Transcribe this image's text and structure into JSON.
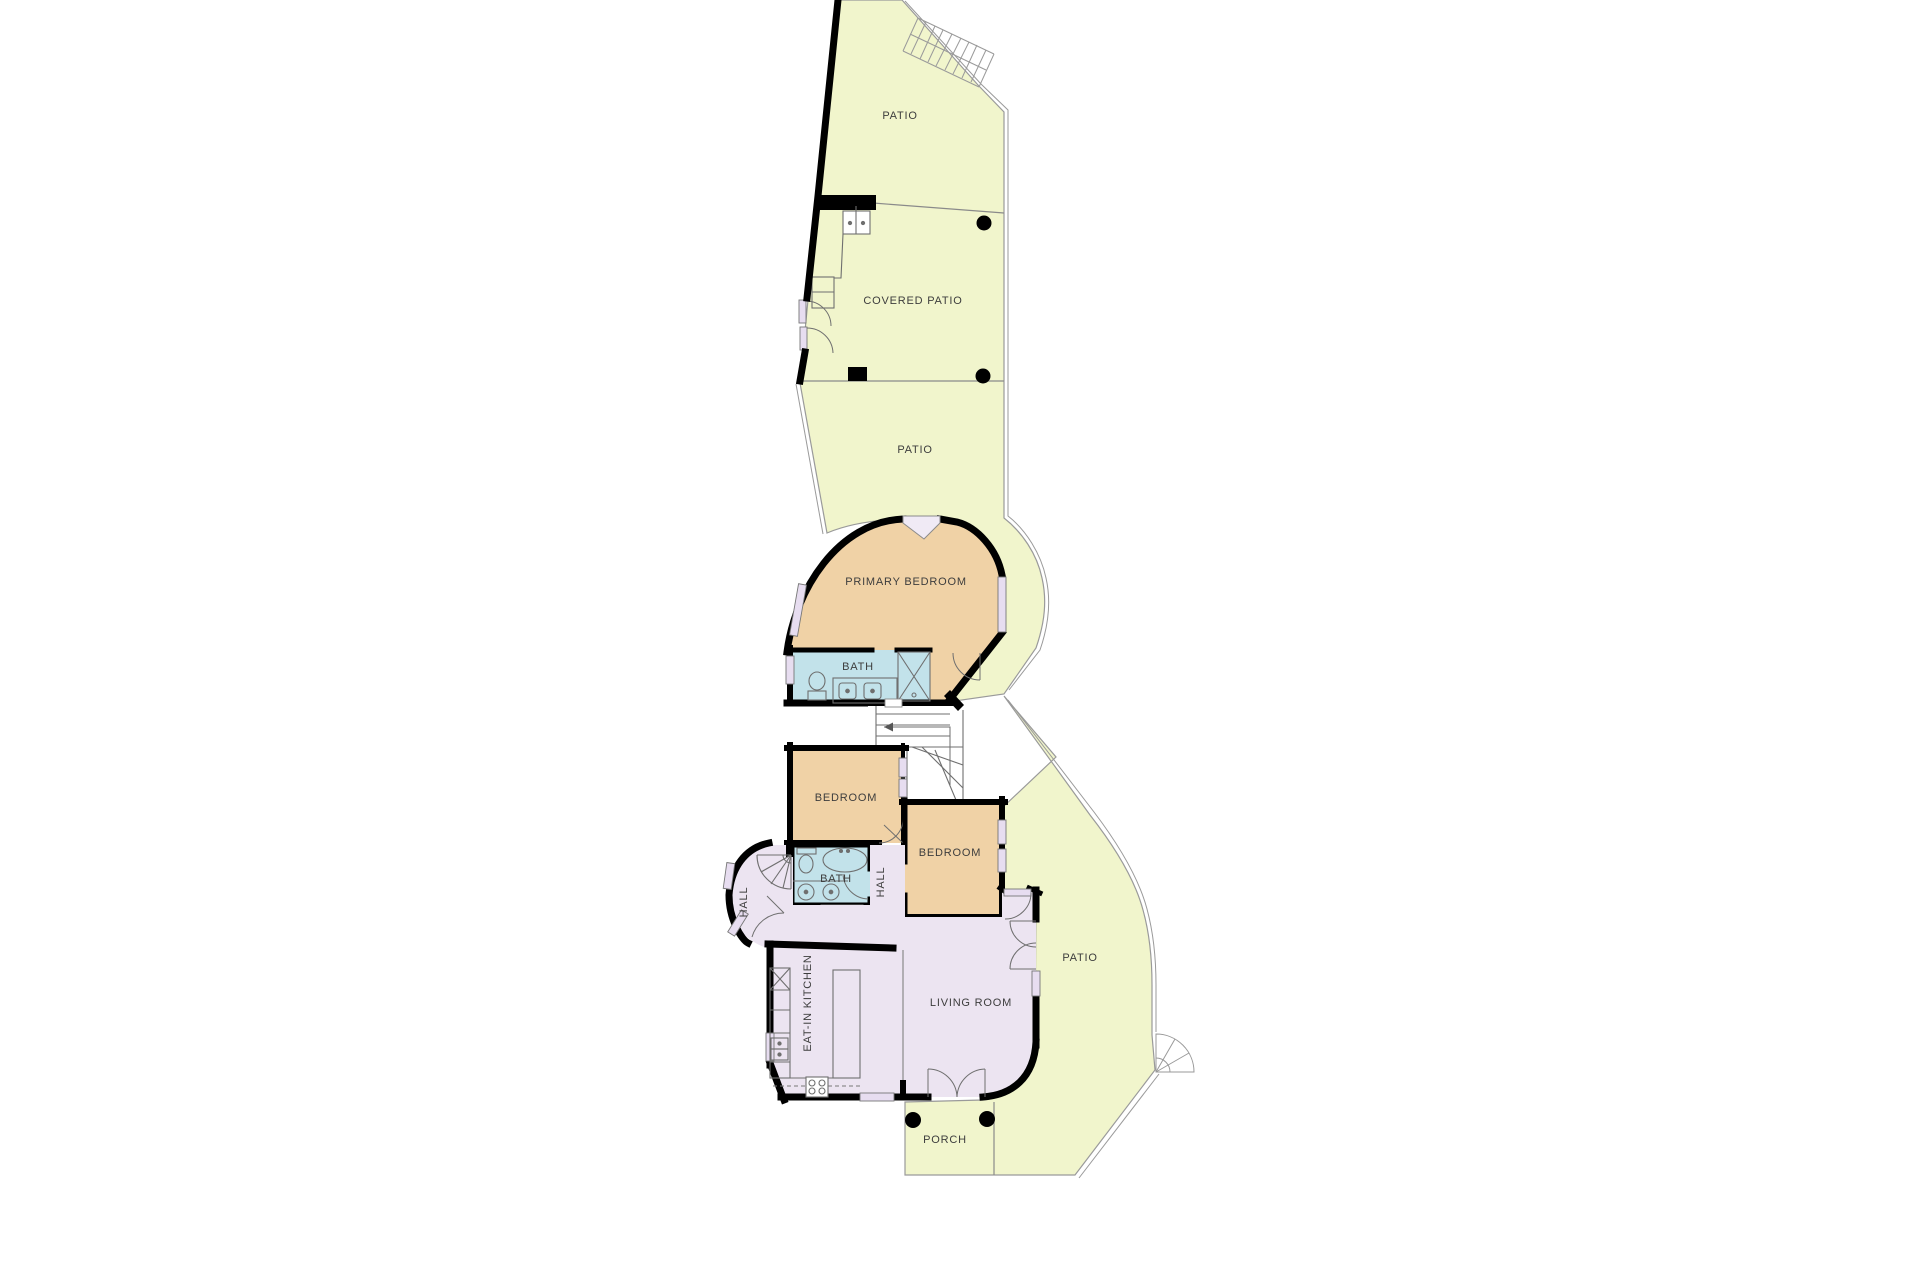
{
  "plan": {
    "labels": {
      "patio_top": "PATIO",
      "covered_patio": "COVERED PATIO",
      "patio_mid": "PATIO",
      "primary_bedroom": "PRIMARY BEDROOM",
      "bath_primary": "BATH",
      "bedroom_left": "BEDROOM",
      "bedroom_right": "BEDROOM",
      "bath_hall": "BATH",
      "hall_entry": "HALL",
      "hall_corridor": "HALL",
      "kitchen": "EAT-IN KITCHEN",
      "living_room": "LIVING ROOM",
      "patio_right": "PATIO",
      "porch": "PORCH"
    },
    "colors": {
      "outdoor": "#f1f5cc",
      "bedroom": "#f0d2a6",
      "bath": "#c2e2ea",
      "interior": "#ece4f1",
      "wall": "#000000",
      "line": "#8a8a8a",
      "background": "#ffffff"
    }
  }
}
